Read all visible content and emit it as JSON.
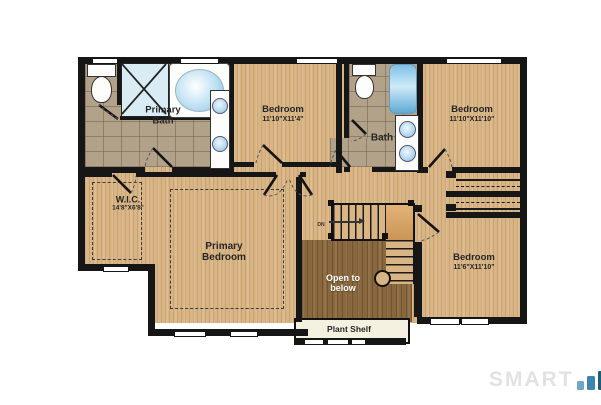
{
  "rooms": {
    "primary_bath": {
      "lines": [
        "Primary",
        "Bath"
      ]
    },
    "bedroom_top_middle": {
      "name": "Bedroom",
      "dims": "11'10\"X11'4\""
    },
    "bath": {
      "name": "Bath"
    },
    "bedroom_top_right": {
      "name": "Bedroom",
      "dims": "11'10\"X11'10\""
    },
    "wic": {
      "name": "W.I.C.",
      "dims": "14'8\"X6'8\""
    },
    "primary_bedroom": {
      "lines": [
        "Primary",
        "Bedroom"
      ]
    },
    "bedroom_bottom_right": {
      "name": "Bedroom",
      "dims": "11'6\"X11'10\""
    },
    "open_to_below": {
      "lines": [
        "Open to",
        "below"
      ]
    },
    "plant_shelf": {
      "label": "Plant Shelf"
    },
    "stairs": {
      "direction_label": "DN"
    }
  },
  "watermark": {
    "text": "SMART"
  },
  "colors": {
    "wood": "#d9b585",
    "wood_dark": "#8a683d",
    "tile": "#b3a28a",
    "wall": "#161616",
    "water_blue": "#8ec7e8",
    "plant_shelf_bg": "#f5f1e0",
    "watermark_gray": "#e2e2e2",
    "bar_light": "#6ea6c8",
    "bar_mid": "#3d85b0",
    "bar_dark": "#1d5c82"
  }
}
